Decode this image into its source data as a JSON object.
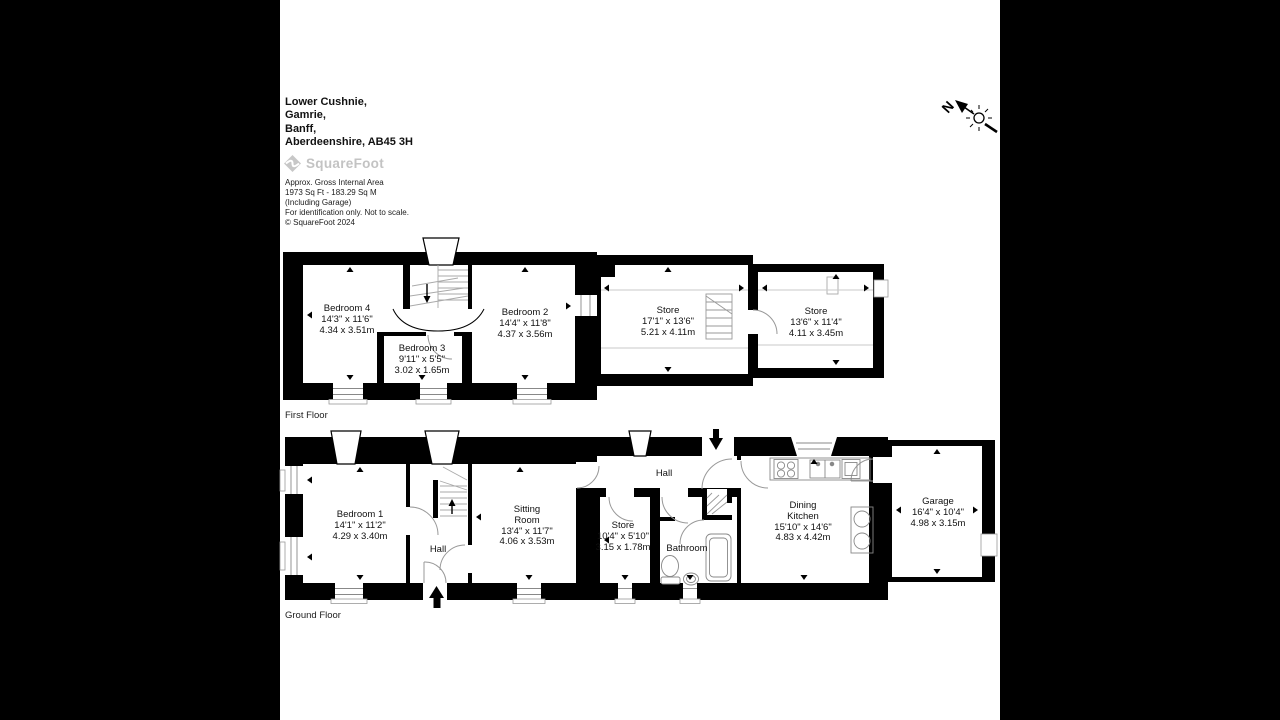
{
  "page": {
    "background_color": "#000000",
    "canvas_color": "#ffffff",
    "wall_color": "#000000",
    "logo_color": "#c3c3c3"
  },
  "header": {
    "address_line_1": "Lower Cushnie,",
    "address_line_2": "Gamrie,",
    "address_line_3": "Banff,",
    "address_line_4": "Aberdeenshire, AB45 3H",
    "logo_text": "SquareFoot",
    "area_line_1": "Approx. Gross Internal Area",
    "area_line_2": "1973 Sq Ft  -  183.29 Sq M",
    "area_line_3": "(Including Garage)",
    "area_line_4": "For identification only. Not to scale.",
    "area_line_5": "© SquareFoot 2024"
  },
  "compass": {
    "north_label": "N"
  },
  "floors": [
    {
      "label": "First Floor",
      "rooms": [
        {
          "name": "Bedroom 4",
          "imperial": "14'3\" x 11'6\"",
          "metric": "4.34 x 3.51m"
        },
        {
          "name": "Bedroom 3",
          "imperial": "9'11\" x 5'5\"",
          "metric": "3.02 x 1.65m"
        },
        {
          "name": "Bedroom 2",
          "imperial": "14'4\" x 11'8\"",
          "metric": "4.37 x 3.56m"
        },
        {
          "name": "Store",
          "imperial": "17'1\" x 13'6\"",
          "metric": "5.21 x 4.11m"
        },
        {
          "name": "Store",
          "imperial": "13'6\" x 11'4\"",
          "metric": "4.11 x 3.45m"
        }
      ]
    },
    {
      "label": "Ground Floor",
      "rooms": [
        {
          "name": "Bedroom 1",
          "imperial": "14'1\" x 11'2\"",
          "metric": "4.29 x 3.40m"
        },
        {
          "name": "Hall"
        },
        {
          "name": "Sitting Room",
          "imperial": "13'4\" x 11'7\"",
          "metric": "4.06 x 3.53m"
        },
        {
          "name": "Hall"
        },
        {
          "name": "Store",
          "imperial": "10'4\" x 5'10\"",
          "metric": "3.15 x 1.78m"
        },
        {
          "name": "Bathroom"
        },
        {
          "name": "Dining Kitchen",
          "imperial": "15'10\" x 14'6\"",
          "metric": "4.83 x 4.42m"
        },
        {
          "name": "Garage",
          "imperial": "16'4\" x 10'4\"",
          "metric": "4.98 x 3.15m"
        }
      ]
    }
  ]
}
